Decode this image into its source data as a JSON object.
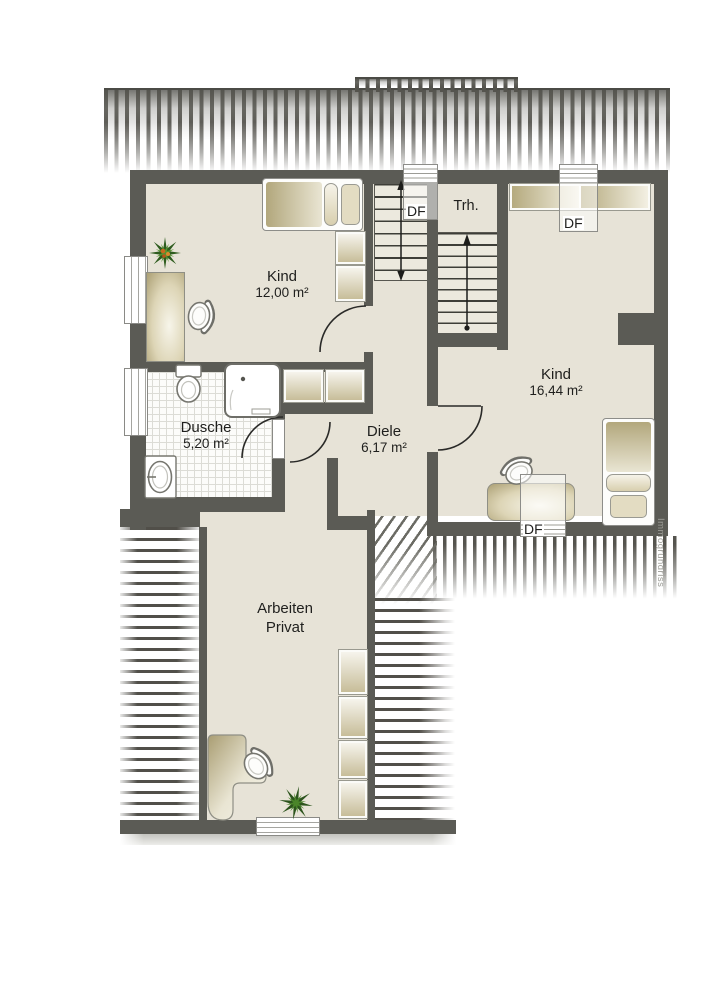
{
  "watermark": "Immogrundriss",
  "stairs": {
    "label": "Trh."
  },
  "roof_window_label": "DF",
  "rooms": {
    "kind_small": {
      "name": "Kind",
      "area": "12,00 m²"
    },
    "kind_large": {
      "name": "Kind",
      "area": "16,44 m²"
    },
    "dusche": {
      "name": "Dusche",
      "area": "5,20 m²"
    },
    "diele": {
      "name": "Diele",
      "area": "6,17 m²"
    },
    "arbeiten": {
      "line1": "Arbeiten",
      "line2": "Privat"
    }
  },
  "colors": {
    "wall": "#5b5b55",
    "floor": "#e7e3d7",
    "furniture_dark": "#b0a478",
    "furniture_light": "#f4f1e6",
    "roof_hatch": "#55544e"
  }
}
